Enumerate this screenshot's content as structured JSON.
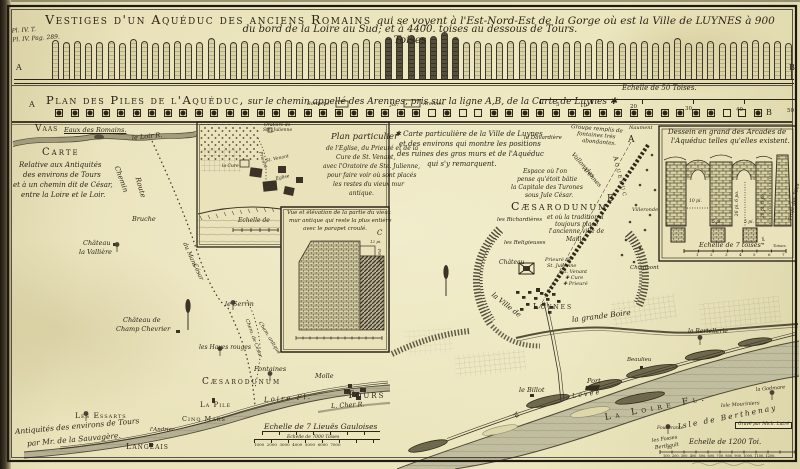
{
  "plate_note": {
    "l1": "Pl. IV. T.",
    "l2": "Pl. IV. Pag. 289."
  },
  "title": {
    "caps": "Vestiges d'un Aquéduc des anciens Romains",
    "rest": "qui se voyent à l'Est-Nord-Est de la Gorge où est la Ville de LUYNES à 900 Toises",
    "line2": "du bord de la Loire au Sud; et à 4400. toises au dessous de Tours."
  },
  "elevation": {
    "pile_count": 67,
    "dark_from": 30,
    "dark_to": 36,
    "labels": [
      {
        "t": "A",
        "x": 16,
        "y": 64,
        "s": 8
      },
      {
        "t": "B",
        "x": 789,
        "y": 64,
        "s": 8
      }
    ]
  },
  "plan_band": {
    "heading_caps": "Plan des Piles de l'Aquéduc,",
    "heading_rest": " sur le chemin appellé des Arennes, pris sur la ligne A,B, de la Carte de Luynes ✱",
    "square_count": 46,
    "open_squares": [
      24,
      26,
      27,
      43,
      44
    ],
    "labels": [
      {
        "t": "Echelle de 50 Toises.",
        "x": 622,
        "y": 85,
        "s": 7,
        "c": "i"
      },
      {
        "t": "5",
        "x": 556,
        "y": 103,
        "s": 5.5
      },
      {
        "t": "10",
        "x": 580,
        "y": 104,
        "s": 5.5
      },
      {
        "t": "20",
        "x": 630,
        "y": 105,
        "s": 5.5
      },
      {
        "t": "30",
        "x": 685,
        "y": 107,
        "s": 5.5
      },
      {
        "t": "40",
        "x": 736,
        "y": 108,
        "s": 5.5
      },
      {
        "t": "50",
        "x": 787,
        "y": 109,
        "s": 5.5
      },
      {
        "t": "Borderie",
        "x": 307,
        "y": 102,
        "s": 5,
        "c": "i"
      },
      {
        "t": "Jar.",
        "x": 390,
        "y": 103,
        "s": 5,
        "c": "i"
      },
      {
        "t": "Arennes",
        "x": 423,
        "y": 102,
        "s": 5,
        "c": "i"
      },
      {
        "t": "A",
        "x": 29,
        "y": 101,
        "s": 8
      },
      {
        "t": "B",
        "x": 766,
        "y": 109,
        "s": 8
      }
    ]
  },
  "left_map": {
    "labels": [
      {
        "t": "Vaas",
        "x": 35,
        "y": 125,
        "s": 9,
        "c": "caps"
      },
      {
        "t": "Eaux des Romains.",
        "x": 64,
        "y": 127,
        "s": 6.5,
        "c": "i u"
      },
      {
        "t": "le Loir R.",
        "x": 132,
        "y": 135,
        "s": 6.5,
        "r": -6,
        "c": "i"
      },
      {
        "t": "Carte",
        "x": 42,
        "y": 148,
        "s": 10,
        "c": "caps sp2"
      },
      {
        "t": "Relative aux Antiquités",
        "x": 19,
        "y": 162,
        "s": 7,
        "c": "i"
      },
      {
        "t": "des environs de Tours",
        "x": 23,
        "y": 172,
        "s": 7,
        "c": "i"
      },
      {
        "t": "et à un chemin dit de César,",
        "x": 13,
        "y": 182,
        "s": 7,
        "c": "i"
      },
      {
        "t": "entre la Loire et le Loir.",
        "x": 21,
        "y": 192,
        "s": 7,
        "c": "i"
      },
      {
        "t": "Chemin",
        "x": 116,
        "y": 163,
        "s": 7,
        "r": 70,
        "c": "i"
      },
      {
        "t": "Route",
        "x": 137,
        "y": 174,
        "s": 7,
        "r": 74,
        "c": "i"
      },
      {
        "t": "Bruche",
        "x": 132,
        "y": 216,
        "s": 6.5,
        "c": "i"
      },
      {
        "t": "du Mans",
        "x": 184,
        "y": 240,
        "s": 6,
        "r": 66,
        "c": "i"
      },
      {
        "t": "César",
        "x": 194,
        "y": 261,
        "s": 6,
        "r": 66,
        "c": "i"
      },
      {
        "t": "Château",
        "x": 83,
        "y": 240,
        "s": 6.5,
        "c": "i"
      },
      {
        "t": "la Vallière",
        "x": 79,
        "y": 249,
        "s": 6.5,
        "c": "i"
      },
      {
        "t": "Château de",
        "x": 123,
        "y": 317,
        "s": 6.5,
        "c": "i"
      },
      {
        "t": "Champ Chevrier",
        "x": 116,
        "y": 326,
        "s": 6.5,
        "c": "i"
      },
      {
        "t": "le Serrin",
        "x": 225,
        "y": 301,
        "s": 6.5,
        "c": "i"
      },
      {
        "t": "les Hayes rouges",
        "x": 199,
        "y": 345,
        "s": 6,
        "c": "i"
      },
      {
        "t": "Chem. de César",
        "x": 246,
        "y": 317,
        "s": 5,
        "r": 70,
        "c": "i"
      },
      {
        "t": "Chem. antique",
        "x": 259,
        "y": 320,
        "s": 5,
        "r": 58,
        "c": "i"
      },
      {
        "t": "Fontaines",
        "x": 254,
        "y": 366,
        "s": 6.5,
        "c": "i"
      },
      {
        "t": "Cæsarodunum",
        "x": 202,
        "y": 378,
        "s": 9,
        "c": "caps sp2"
      },
      {
        "t": "Molle",
        "x": 315,
        "y": 373,
        "s": 6.5,
        "c": "i"
      },
      {
        "t": "Tours",
        "x": 347,
        "y": 391,
        "s": 10,
        "c": "caps sp2"
      },
      {
        "t": "La Pile",
        "x": 200,
        "y": 402,
        "s": 7,
        "c": "caps"
      },
      {
        "t": "Cinq Mars",
        "x": 182,
        "y": 416,
        "s": 6.5,
        "c": "caps"
      },
      {
        "t": "Loire Fl.",
        "x": 264,
        "y": 397,
        "s": 7,
        "r": -4,
        "c": "i sp2"
      },
      {
        "t": "L. Cher R.",
        "x": 331,
        "y": 403,
        "s": 6.5,
        "r": -3,
        "c": "i"
      },
      {
        "t": "l'Andrier",
        "x": 150,
        "y": 428,
        "s": 5.5,
        "c": "i"
      },
      {
        "t": "Les Essarts",
        "x": 75,
        "y": 412,
        "s": 7.5,
        "c": "caps"
      },
      {
        "t": "Antiquités des environs de Tours",
        "x": 15,
        "y": 428,
        "s": 7.5,
        "r": -5,
        "c": "i"
      },
      {
        "t": "par Mr. de la Sauvagère.",
        "x": 27,
        "y": 440,
        "s": 7.5,
        "r": -5,
        "c": "i"
      },
      {
        "t": "Langeais",
        "x": 126,
        "y": 443,
        "s": 8,
        "c": "caps"
      },
      {
        "t": "Echelle de 7 Lieuës Gauloises",
        "x": 264,
        "y": 423,
        "s": 7.5,
        "c": "i"
      },
      {
        "t": "Echelle de 7000 Toises",
        "x": 287,
        "y": 436,
        "s": 4.5,
        "c": "i"
      },
      {
        "t": "1000  2000  3000  4000  5000  6000  7000",
        "x": 254,
        "y": 443,
        "s": 4
      }
    ]
  },
  "inset_plan": {
    "labels": [
      {
        "t": "Oratoire de",
        "x": 264,
        "y": 124,
        "s": 4.5,
        "c": "i"
      },
      {
        "t": "Ste. Julienne",
        "x": 263,
        "y": 129,
        "s": 4.5,
        "c": "i"
      },
      {
        "t": "Plan particulier",
        "x": 331,
        "y": 133,
        "s": 8.5,
        "c": "i"
      },
      {
        "t": "de l'Eglise, du Prieuré et de la",
        "x": 326,
        "y": 146,
        "s": 6,
        "c": "i"
      },
      {
        "t": "Cure de St. Venant,",
        "x": 336,
        "y": 155,
        "s": 6,
        "c": "i"
      },
      {
        "t": "avec l'Oratoire de Ste. Julienne,",
        "x": 323,
        "y": 164,
        "s": 6,
        "c": "i"
      },
      {
        "t": "pour faire voir où sont placés",
        "x": 327,
        "y": 173,
        "s": 6,
        "c": "i"
      },
      {
        "t": "les restes du vieux mur",
        "x": 333,
        "y": 182,
        "s": 6,
        "c": "i"
      },
      {
        "t": "antique.",
        "x": 349,
        "y": 191,
        "s": 6,
        "c": "i"
      },
      {
        "t": "Prieuré",
        "x": 259,
        "y": 150,
        "s": 4.5,
        "r": 72,
        "c": "i"
      },
      {
        "t": "St. Venant",
        "x": 266,
        "y": 160,
        "s": 4.5,
        "r": -12,
        "c": "i"
      },
      {
        "t": "Eglise",
        "x": 276,
        "y": 178,
        "s": 4.5,
        "r": -12,
        "c": "i"
      },
      {
        "t": "la Cure",
        "x": 222,
        "y": 165,
        "s": 4.5,
        "c": "i"
      },
      {
        "t": "Echelle de",
        "x": 238,
        "y": 218,
        "s": 6,
        "c": "i"
      }
    ]
  },
  "inset_wall": {
    "labels": [
      {
        "t": "Vue et élévation de la partie du vieux",
        "x": 287,
        "y": 211,
        "s": 5.5,
        "c": "i"
      },
      {
        "t": "mur antique qui reste la plus entière",
        "x": 289,
        "y": 219,
        "s": 5.5,
        "c": "i"
      },
      {
        "t": "avec le parapet croulé.",
        "x": 303,
        "y": 227,
        "s": 5.5,
        "c": "i"
      },
      {
        "t": "C",
        "x": 377,
        "y": 230,
        "s": 7,
        "c": "i"
      },
      {
        "t": "12 pi.",
        "x": 370,
        "y": 240,
        "s": 4,
        "c": "i"
      },
      {
        "t": "Parapet",
        "x": 379,
        "y": 247,
        "s": 4,
        "r": 85,
        "c": "i"
      }
    ]
  },
  "right_map": {
    "labels": [
      {
        "t": "✱ Carte particulière de la Ville de Luynes",
        "x": 395,
        "y": 131,
        "s": 7,
        "c": "i"
      },
      {
        "t": "et des environs qui montre les positions",
        "x": 399,
        "y": 141,
        "s": 7,
        "c": "i"
      },
      {
        "t": "des ruines des gros murs et de l'Aquéduc",
        "x": 397,
        "y": 151,
        "s": 7,
        "c": "i"
      },
      {
        "t": "qui s'y remarquent.",
        "x": 427,
        "y": 161,
        "s": 7,
        "c": "i"
      },
      {
        "t": "la Davardière",
        "x": 524,
        "y": 136,
        "s": 5.5,
        "c": "i"
      },
      {
        "t": "Groupe remplis de",
        "x": 571,
        "y": 125,
        "s": 5.5,
        "r": 5,
        "c": "i"
      },
      {
        "t": "fontaines très",
        "x": 577,
        "y": 132,
        "s": 5.5,
        "r": 5,
        "c": "i"
      },
      {
        "t": "abondantes.",
        "x": 582,
        "y": 139,
        "s": 5.5,
        "r": 5,
        "c": "i"
      },
      {
        "t": "Naument",
        "x": 629,
        "y": 126,
        "s": 5,
        "c": "i"
      },
      {
        "t": "A",
        "x": 628,
        "y": 136,
        "s": 9
      },
      {
        "t": "Vallon des",
        "x": 572,
        "y": 151,
        "s": 6,
        "r": 48,
        "c": "i"
      },
      {
        "t": "Arennes",
        "x": 583,
        "y": 165,
        "s": 6,
        "r": 48,
        "c": "i"
      },
      {
        "t": "Aqueduc",
        "x": 615,
        "y": 153,
        "s": 6.5,
        "r": 76,
        "c": "caps sp2"
      },
      {
        "t": "B",
        "x": 607,
        "y": 195,
        "s": 9
      },
      {
        "t": "Villeronde",
        "x": 632,
        "y": 208,
        "s": 5,
        "c": "i"
      },
      {
        "t": "Espace où l'on",
        "x": 523,
        "y": 169,
        "s": 6,
        "c": "i"
      },
      {
        "t": "pense qu'étoit bâtie",
        "x": 517,
        "y": 177,
        "s": 6,
        "c": "i"
      },
      {
        "t": "la Capitale des Turones",
        "x": 511,
        "y": 185,
        "s": 6,
        "c": "i"
      },
      {
        "t": "sous Jule César.",
        "x": 525,
        "y": 193,
        "s": 6,
        "c": "i"
      },
      {
        "t": "Cæsarodunum",
        "x": 511,
        "y": 201,
        "s": 11,
        "c": "caps sp2"
      },
      {
        "t": "et où la tradition a",
        "x": 547,
        "y": 215,
        "s": 6,
        "c": "i"
      },
      {
        "t": "les Richardières",
        "x": 497,
        "y": 218,
        "s": 5.5,
        "c": "i"
      },
      {
        "t": "toujours placé",
        "x": 555,
        "y": 222,
        "s": 6,
        "c": "i"
      },
      {
        "t": "l'ancienne ville de",
        "x": 549,
        "y": 229,
        "s": 6,
        "c": "i"
      },
      {
        "t": "Maillé.",
        "x": 566,
        "y": 237,
        "s": 6,
        "c": "i"
      },
      {
        "t": "les Religieuses",
        "x": 504,
        "y": 241,
        "s": 5.5,
        "c": "i"
      },
      {
        "t": "Château",
        "x": 499,
        "y": 260,
        "s": 6,
        "c": "i"
      },
      {
        "t": "Prieuré de",
        "x": 545,
        "y": 258,
        "s": 5,
        "c": "i"
      },
      {
        "t": "St. Julienne",
        "x": 547,
        "y": 264,
        "s": 5,
        "c": "i"
      },
      {
        "t": "St. Venant",
        "x": 561,
        "y": 270,
        "s": 5,
        "c": "i"
      },
      {
        "t": "✚ Cure",
        "x": 565,
        "y": 276,
        "s": 5,
        "c": "i"
      },
      {
        "t": "✚ Prieuré",
        "x": 563,
        "y": 282,
        "s": 5,
        "c": "i"
      },
      {
        "t": "la Ville de",
        "x": 492,
        "y": 291,
        "s": 7,
        "r": 38,
        "c": "i"
      },
      {
        "t": "Luynes",
        "x": 533,
        "y": 303,
        "s": 8,
        "c": "caps sp2"
      },
      {
        "t": "la grande Boire",
        "x": 572,
        "y": 316,
        "s": 7.5,
        "r": -7,
        "c": "i"
      },
      {
        "t": "Chaumont",
        "x": 630,
        "y": 266,
        "s": 5.5,
        "c": "i"
      },
      {
        "t": "le Billot",
        "x": 519,
        "y": 387,
        "s": 6.5,
        "c": "i"
      },
      {
        "t": "Port",
        "x": 587,
        "y": 378,
        "s": 6.5,
        "c": "i"
      },
      {
        "t": "la",
        "x": 514,
        "y": 410,
        "s": 6.5,
        "r": 40,
        "c": "i"
      },
      {
        "t": "Levée",
        "x": 572,
        "y": 393,
        "s": 6.5,
        "r": -8,
        "c": "i sp2"
      },
      {
        "t": "La Loire Fl.",
        "x": 605,
        "y": 414,
        "s": 9,
        "r": -11,
        "c": "caps sp4"
      },
      {
        "t": "Beaulieu",
        "x": 627,
        "y": 358,
        "s": 5.5,
        "c": "i"
      },
      {
        "t": "la Bertellerie",
        "x": 688,
        "y": 329,
        "s": 6,
        "c": "i"
      },
      {
        "t": "la Godmare",
        "x": 756,
        "y": 388,
        "s": 5,
        "r": -5,
        "c": "i"
      },
      {
        "t": "Isle Mouriniers",
        "x": 721,
        "y": 404,
        "s": 5,
        "r": -4,
        "c": "i"
      },
      {
        "t": "Isle de Berthenay",
        "x": 678,
        "y": 423,
        "s": 7.5,
        "r": -11,
        "c": "i sp2"
      },
      {
        "t": "Fouderante",
        "x": 657,
        "y": 427,
        "s": 4.5,
        "c": "i"
      },
      {
        "t": "Gravé par Mich. Lutré",
        "x": 735,
        "y": 422,
        "s": 4.5,
        "c": "i box"
      },
      {
        "t": "les Fosses",
        "x": 652,
        "y": 439,
        "s": 5,
        "r": -8,
        "c": "i"
      },
      {
        "t": "Berthault",
        "x": 655,
        "y": 446,
        "s": 5,
        "r": -8,
        "c": "i"
      },
      {
        "t": "Echelle de 1200 Toi.",
        "x": 689,
        "y": 439,
        "s": 7,
        "c": "i"
      },
      {
        "t": "50",
        "x": 667,
        "y": 446,
        "s": 4
      },
      {
        "t": "100. 200. 300. 400. 500. 600. 700. 800. 900. 1000. 1100. 1200.",
        "x": 663,
        "y": 455,
        "s": 3.5
      }
    ]
  },
  "panel": {
    "labels": [
      {
        "t": "Dessein en grand des Arcades de",
        "x": 668,
        "y": 129,
        "s": 7,
        "c": "i"
      },
      {
        "t": "l'Aquéduc telles qu'elles existent.",
        "x": 671,
        "y": 138,
        "s": 7,
        "c": "i"
      },
      {
        "t": "10 pi.",
        "x": 689,
        "y": 200,
        "s": 4.5,
        "c": "i"
      },
      {
        "t": "26 pi. 6 po.",
        "x": 738,
        "y": 214,
        "s": 4.5,
        "r": -90,
        "c": "i"
      },
      {
        "t": "28 pi. 6 po.",
        "x": 764,
        "y": 216,
        "s": 4.5,
        "r": -90,
        "c": "i"
      },
      {
        "t": "Profil des Piles",
        "x": 791,
        "y": 218,
        "s": 5,
        "r": -78,
        "c": "i"
      },
      {
        "t": "5 pi.",
        "x": 712,
        "y": 221,
        "s": 4.5,
        "c": "i"
      },
      {
        "t": "5 pi.",
        "x": 744,
        "y": 221,
        "s": 4.5,
        "c": "i"
      },
      {
        "t": "4 pi.",
        "x": 763,
        "y": 243,
        "s": 4,
        "r": -90,
        "c": "i"
      },
      {
        "t": "Echelle de 7 toises",
        "x": 699,
        "y": 242,
        "s": 6.5,
        "c": "i"
      },
      {
        "t": "Toises.",
        "x": 773,
        "y": 244,
        "s": 4,
        "c": "i"
      },
      {
        "t": "1",
        "x": 696,
        "y": 253,
        "s": 4
      },
      {
        "t": "2",
        "x": 710,
        "y": 253,
        "s": 4
      },
      {
        "t": "3",
        "x": 725,
        "y": 253,
        "s": 4
      },
      {
        "t": "4",
        "x": 739,
        "y": 253,
        "s": 4
      },
      {
        "t": "5",
        "x": 753,
        "y": 253,
        "s": 4
      },
      {
        "t": "6",
        "x": 768,
        "y": 253,
        "s": 4
      },
      {
        "t": "7",
        "x": 782,
        "y": 253,
        "s": 4
      }
    ]
  }
}
